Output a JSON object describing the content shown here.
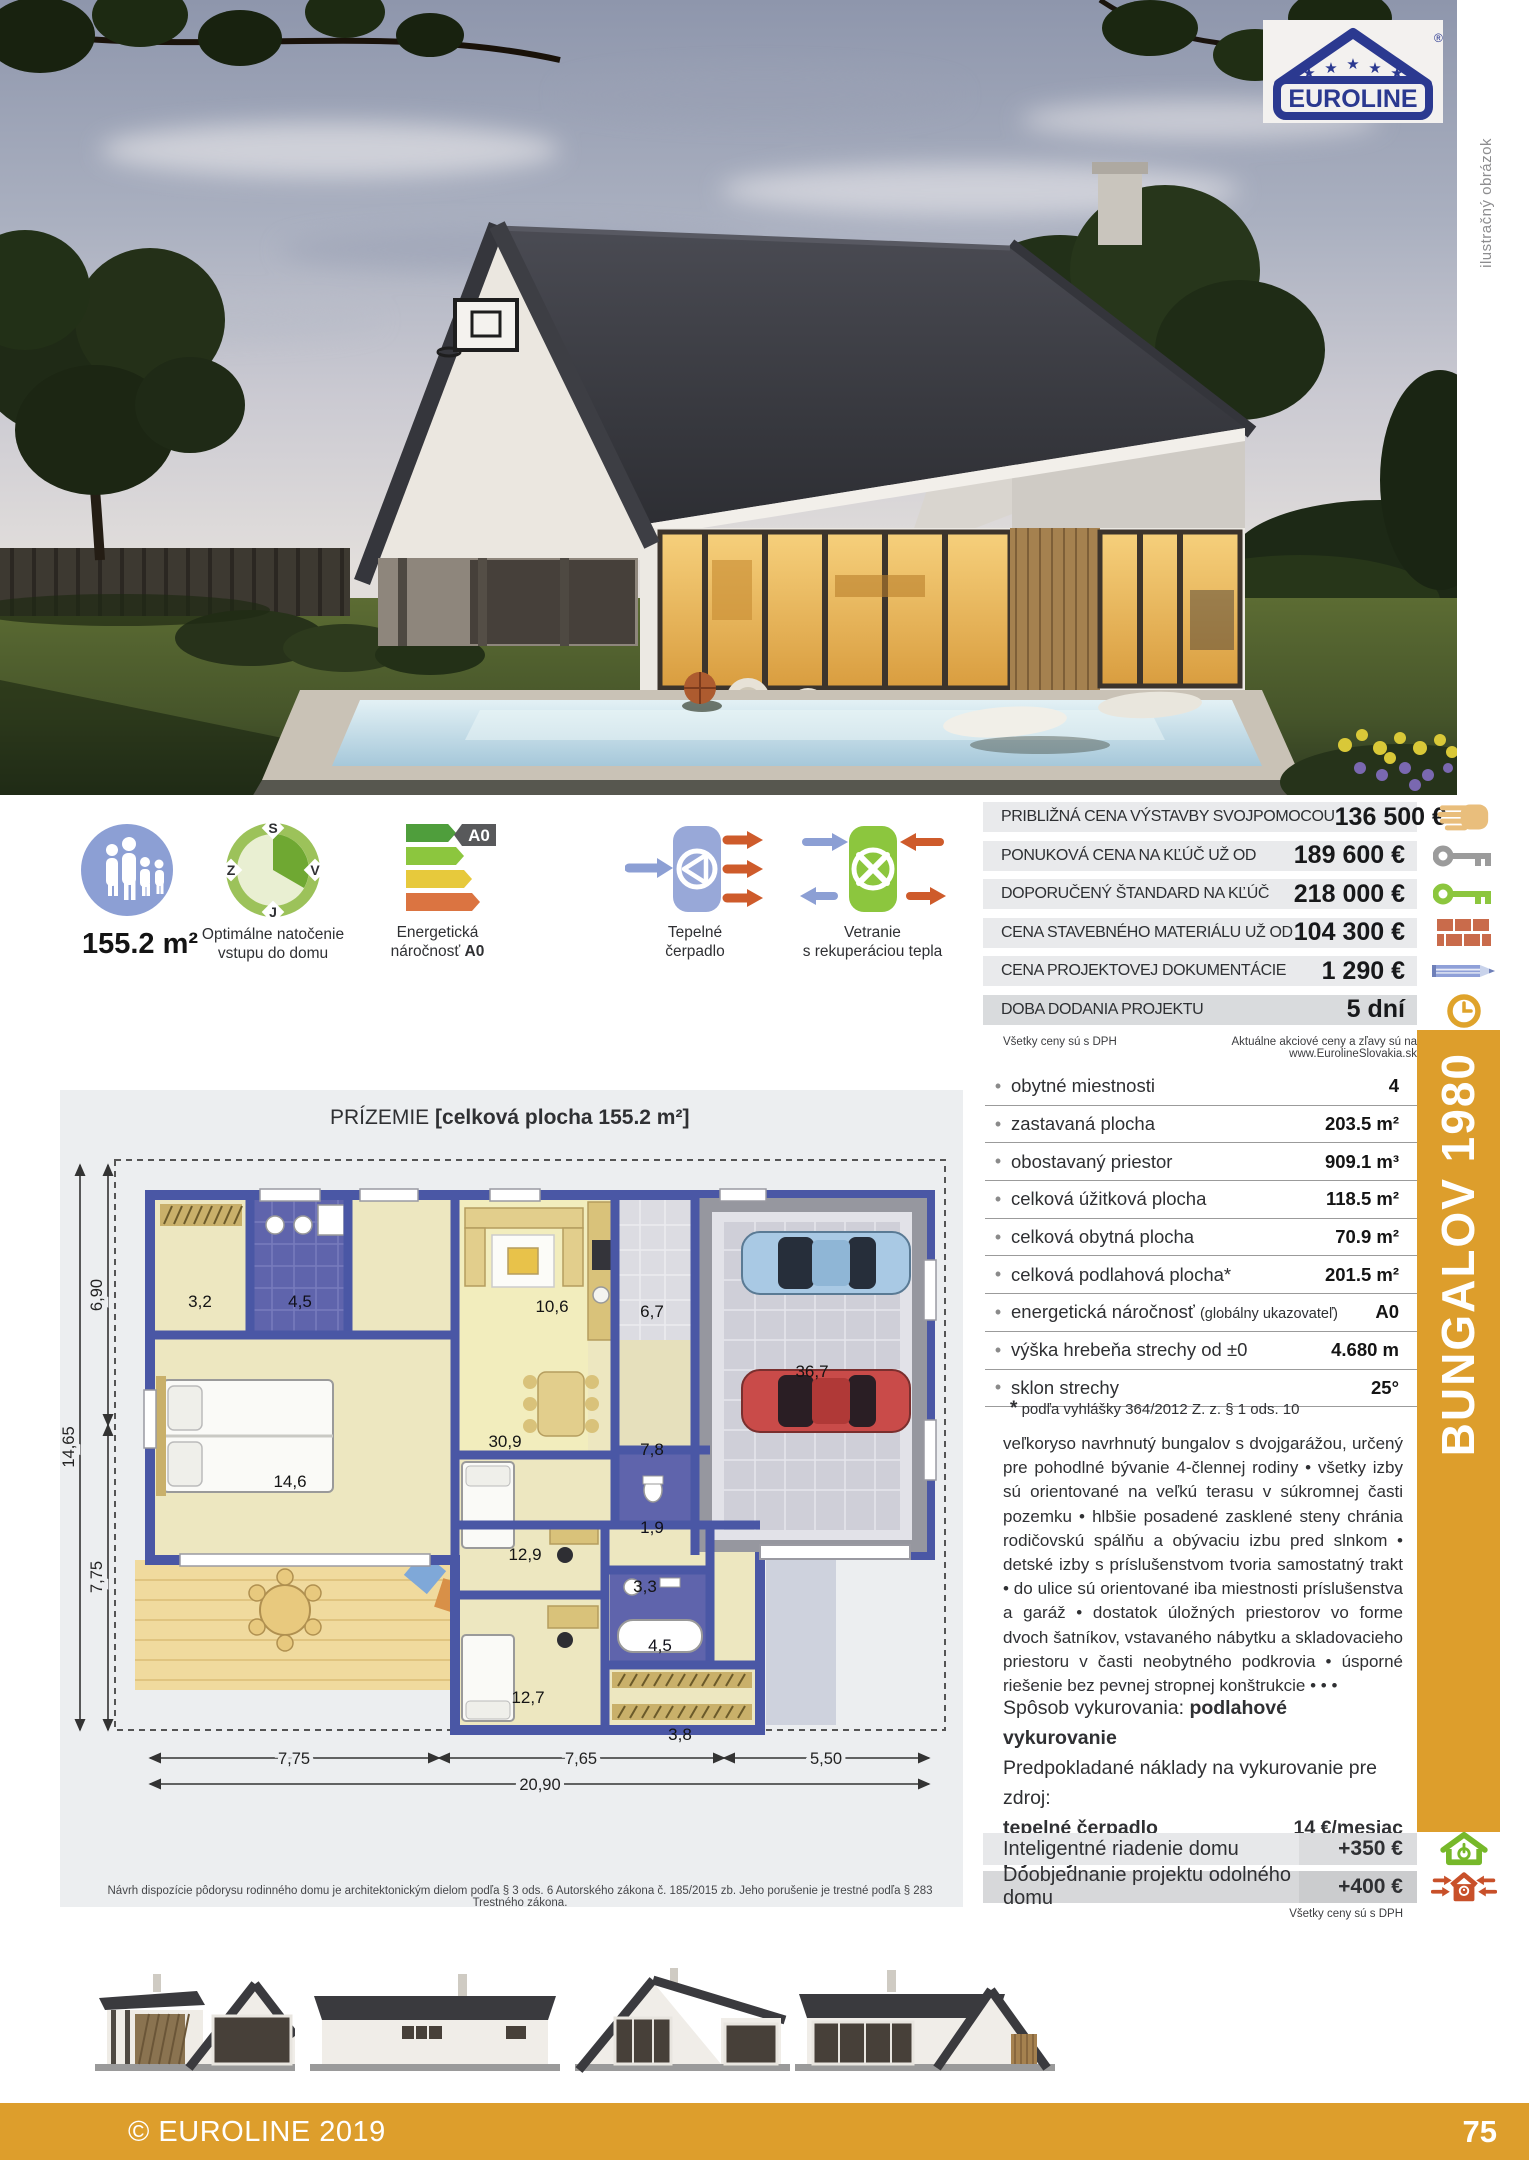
{
  "brand": {
    "logo_text": "EUROLINE",
    "registered_mark": "®"
  },
  "photo_note": "ilustračný obrázok",
  "model": {
    "name": "BUNGALOV 1980",
    "accent_color": "#DD9E2C"
  },
  "features": {
    "area_value": "155.2 m²",
    "orientation": {
      "label_line1": "Optimálne natočenie",
      "label_line2": "vstupu do domu",
      "compass_n": "S",
      "compass_w": "Z",
      "compass_e": "V",
      "compass_s": "J"
    },
    "energy": {
      "label_line1": "Energetická",
      "label_line2": "náročnosť ",
      "class_bold": "A0",
      "badge": "A0"
    },
    "heatpump": {
      "label_line1": "Tepelné",
      "label_line2": "čerpadlo"
    },
    "ventilation": {
      "label_line1": "Vetranie",
      "label_line2": "s rekuperáciou tepla"
    }
  },
  "prices": {
    "rows": [
      {
        "label": "PRIBLIŽNÁ CENA VÝSTAVBY SVOJPOMOCOU",
        "value": "136 500 €",
        "icon": "hand-icon"
      },
      {
        "label": "PONUKOVÁ CENA NA KĽÚČ UŽ OD",
        "value": "189 600 €",
        "icon": "key-gray-icon"
      },
      {
        "label": "DOPORUČENÝ ŠTANDARD NA KĽÚČ",
        "value": "218 000 €",
        "icon": "key-green-icon"
      },
      {
        "label": "CENA STAVEBNÉHO MATERIÁLU UŽ OD",
        "value": "104 300 €",
        "icon": "bricks-icon"
      },
      {
        "label": "CENA PROJEKTOVEJ DOKUMENTÁCIE",
        "value": "1 290 €",
        "icon": "pencil-icon"
      },
      {
        "label": "DOBA DODANIA PROJEKTU",
        "value": "5 dní",
        "icon": "clock-icon"
      }
    ],
    "vat_note": "Všetky ceny sú s DPH",
    "promo_note": "Aktuálne akciové ceny a zľavy sú na www.EurolineSlovakia.sk"
  },
  "specs": {
    "rows": [
      {
        "label": "obytné miestnosti",
        "label_small": "",
        "value": "4"
      },
      {
        "label": "zastavaná plocha",
        "label_small": "",
        "value": "203.5 m²"
      },
      {
        "label": "obostavaný priestor",
        "label_small": "",
        "value": "909.1 m³"
      },
      {
        "label": "celková úžitková plocha",
        "label_small": "",
        "value": "118.5 m²"
      },
      {
        "label": "celková obytná plocha",
        "label_small": "",
        "value": "70.9 m²"
      },
      {
        "label": "celková podlahová plocha*",
        "label_small": "",
        "value": "201.5 m²"
      },
      {
        "label": "energetická náročnosť ",
        "label_small": "(globálny ukazovateľ)",
        "value": "A0"
      },
      {
        "label": "výška hrebeňa strechy od ±0",
        "label_small": "",
        "value": "4.680 m"
      },
      {
        "label": "sklon strechy",
        "label_small": "",
        "value": "25°"
      }
    ],
    "footnote_star": "*",
    "footnote": "podľa vyhlášky 364/2012 Z. z. § 1 ods. 10"
  },
  "description": "veľkoryso navrhnutý bungalov s dvojgarážou, určený pre pohodlné bývanie 4-člennej rodiny  •  všetky izby sú orientované na veľkú terasu v súkromnej časti pozemku  •  hlbšie posadené zasklené steny chránia rodičovskú spálňu a obývaciu izbu pred slnkom  •  detské izby s príslušenstvom tvoria samostatný trakt  •  do ulice sú orientované iba miestnosti príslušenstva a garáž  •  dostatok úložných priestorov vo forme dvoch šatníkov, vstavaného nábytku a skladovacieho priestoru v časti neobytného podkrovia  •  úsporné riešenie bez pevnej stropnej konštrukcie  • • •",
  "heating": {
    "method_label": "Spôsob vykurovania: ",
    "method_value": "podlahové vykurovanie",
    "costs_intro": "Predpokladané náklady na vykurovanie pre zdroj:",
    "rows": [
      {
        "label": "tepelné čerpadlo",
        "value": "14 €/mesiac"
      },
      {
        "label": "plynový kotol",
        "value": "22 €/mesiac"
      }
    ]
  },
  "addons": {
    "rows": [
      {
        "label": "Inteligentné riadenie domu",
        "value": "+350 €",
        "icon": "smart-home-icon"
      },
      {
        "label": "Doobjednanie projektu odolného domu",
        "value": "+400 €",
        "icon": "resilient-home-icon"
      }
    ],
    "vat_note": "Všetky ceny sú s DPH"
  },
  "floorplan": {
    "title": "PRÍZEMIE ",
    "subtitle": "[celková plocha 155.2 m²]",
    "rooms": [
      "3,2",
      "4,5",
      "14,6",
      "10,6",
      "6,7",
      "36,7",
      "30,9",
      "7,8",
      "12,9",
      "3,3",
      "1,9",
      "4,5",
      "12,7",
      "3,8"
    ],
    "dims": {
      "left_total": "14,65",
      "left_a": "6,90",
      "left_b": "7,75",
      "bottom_a": "7,75",
      "bottom_b": "7,65",
      "bottom_c": "5,50",
      "bottom_total": "20,90"
    }
  },
  "legal": "Návrh dispozície pôdorysu rodinného domu je architektonickým dielom podľa § 3 ods. 6 Autorského zákona č. 185/2015 zb. Jeho porušenie je trestné podľa § 283 Trestného zákona.",
  "footer": {
    "copyright": "© EUROLINE 2019",
    "page_number": "75"
  }
}
